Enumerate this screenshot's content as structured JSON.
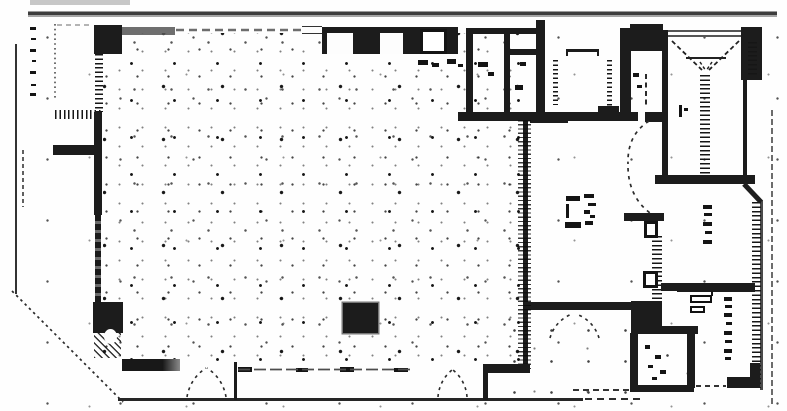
{
  "canvas": {
    "width": 787,
    "height": 411,
    "paper_color": "#fefefe",
    "ink_color": "#1c1c1c",
    "site_line_gray": "#6e6e6e"
  },
  "plan": {
    "type": "scanned-architectural-floor-plan",
    "legible_text": [],
    "annotations": [
      {
        "name": "left-margin-dimension-marks",
        "legible": false
      },
      {
        "name": "top-band-fixture-marks",
        "legible": false
      },
      {
        "name": "mid-room-ratio-note-marks",
        "legible": false
      },
      {
        "name": "elevator-lobby-mark",
        "legible": false
      },
      {
        "name": "right-room-vertical-label-marks",
        "legible": false
      },
      {
        "name": "kitchenette-vertical-label-marks",
        "legible": false
      }
    ],
    "symbols": [
      {
        "name": "elevator-cab-symbol",
        "count": 1
      },
      {
        "name": "double-door-swing",
        "count": 3
      },
      {
        "name": "sliding-door-s-curve",
        "count": 1
      },
      {
        "name": "filled-column-shaft",
        "count": 3
      },
      {
        "name": "hatched-wall-segments",
        "count": 7
      },
      {
        "name": "stipple-floor-texture",
        "count": 1
      },
      {
        "name": "sink-fixture",
        "count": 1
      },
      {
        "name": "chamfered-site-line",
        "count": 1
      }
    ]
  }
}
